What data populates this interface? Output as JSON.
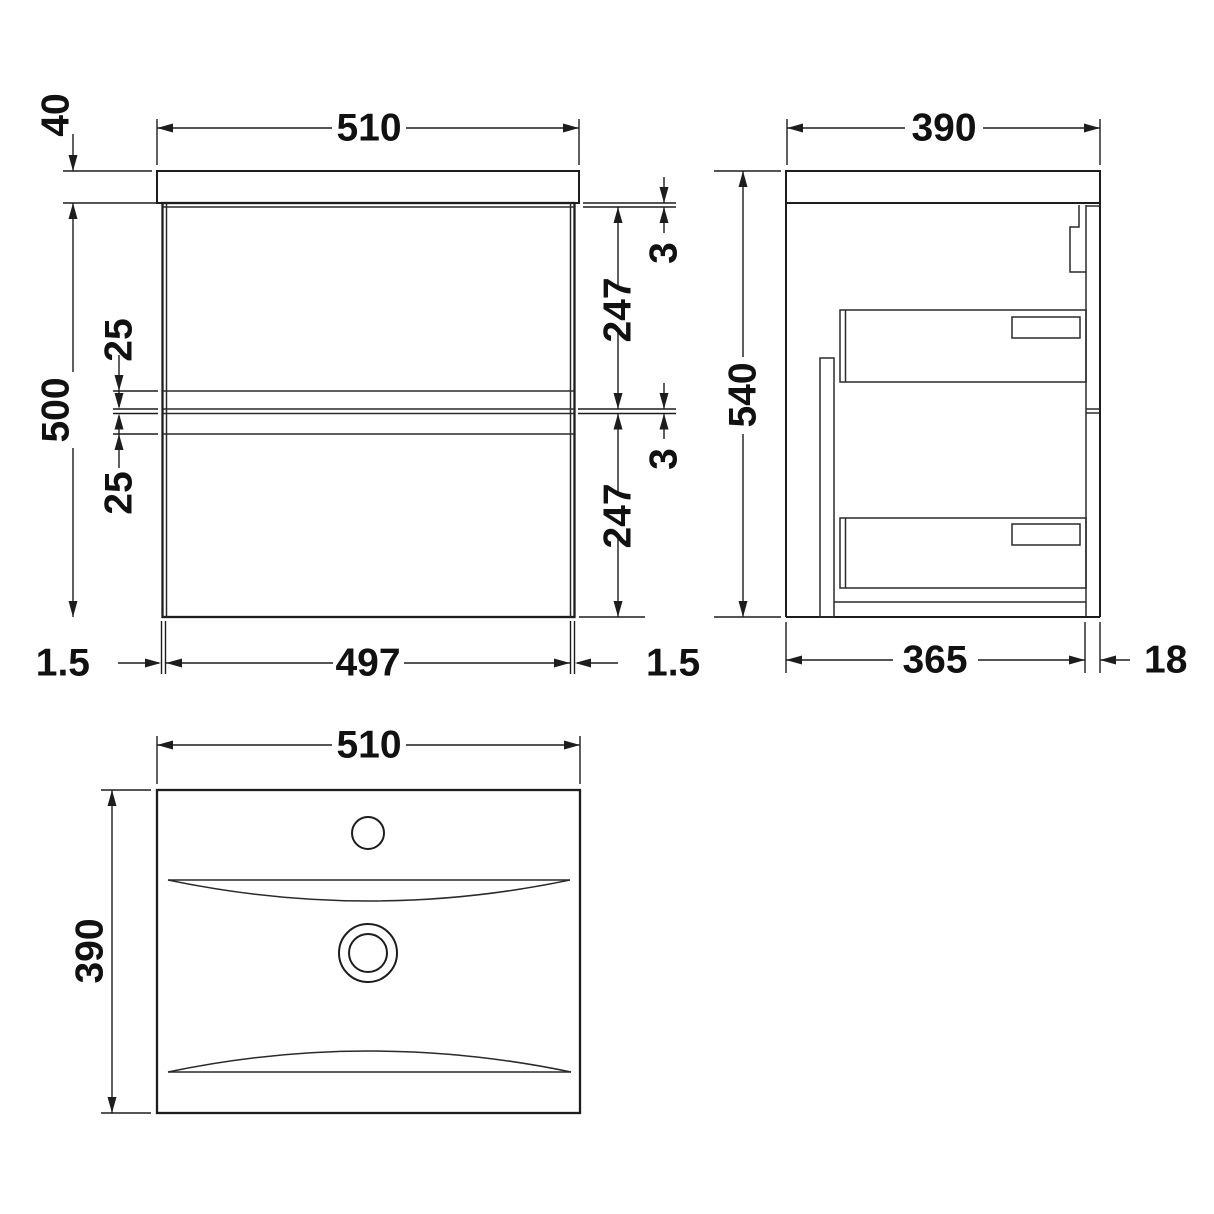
{
  "drawing": {
    "front_view": {
      "width": "510",
      "worktop_thickness": "40",
      "cabinet_height": "500",
      "rail_offset_top": "25",
      "rail_offset_bottom": "25",
      "gap_below_worktop": "3",
      "drawer_front_height_1": "247",
      "gap_between_drawers": "3",
      "drawer_front_height_2": "247",
      "side_panel_left": "1.5",
      "internal_width": "497",
      "side_panel_right": "1.5"
    },
    "side_view": {
      "depth": "390",
      "height": "540",
      "cabinet_depth": "365",
      "back_rail_depth": "18"
    },
    "plan_view": {
      "width": "510",
      "depth": "390"
    }
  }
}
